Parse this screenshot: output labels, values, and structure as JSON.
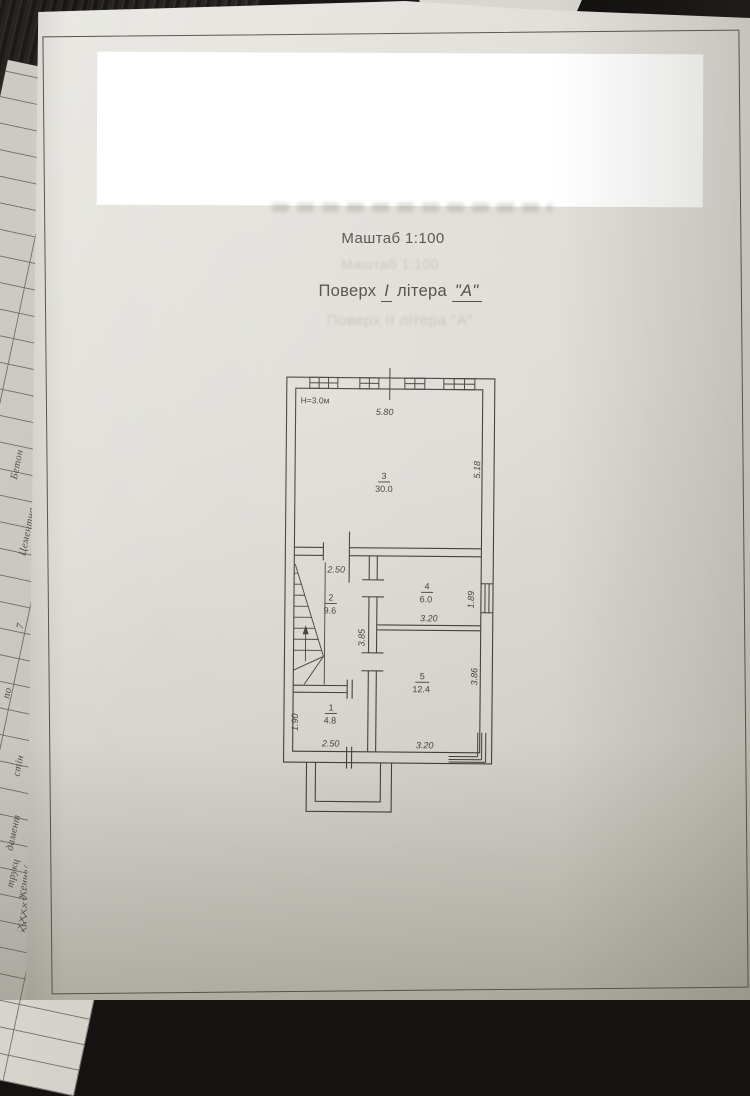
{
  "document": {
    "scale_title": "Маштаб 1:100",
    "scale_title_ghost": "Маштаб 1:100",
    "floor_title": {
      "word_floor": "Поверх",
      "floor_numeral": "І",
      "word_letter": "літера",
      "letter_value": "\"А\""
    },
    "floor_title_ghost": "Поверх ІІ літера \"А\"",
    "height_note": "Н=3.0м"
  },
  "plan": {
    "rooms": [
      {
        "num": "3",
        "area": "30.0"
      },
      {
        "num": "2",
        "area": "9.6"
      },
      {
        "num": "4",
        "area": "6.0"
      },
      {
        "num": "5",
        "area": "12.4"
      },
      {
        "num": "1",
        "area": "4.8"
      }
    ],
    "dims": {
      "top_width": "5.80",
      "room3_right": "5.18",
      "room2_top": "2.50",
      "room2_wall": "3.85",
      "room4_window": "1.89",
      "room4_bottom": "3.20",
      "room5_right": "3.86",
      "room5_bottom": "3.20",
      "room1_left": "1.90",
      "room1_bottom": "2.50"
    }
  },
  "side_sheet": {
    "labels": [
      "Бетон",
      "Цементна",
      "стяжка",
      "7",
      "по",
      "стін",
      "дамент",
      "трукц",
      "ження/"
    ]
  },
  "colors": {
    "paper": "#dedcd6",
    "background": "#141312",
    "ink": "#3e3a34",
    "redaction": "#ffffff"
  }
}
